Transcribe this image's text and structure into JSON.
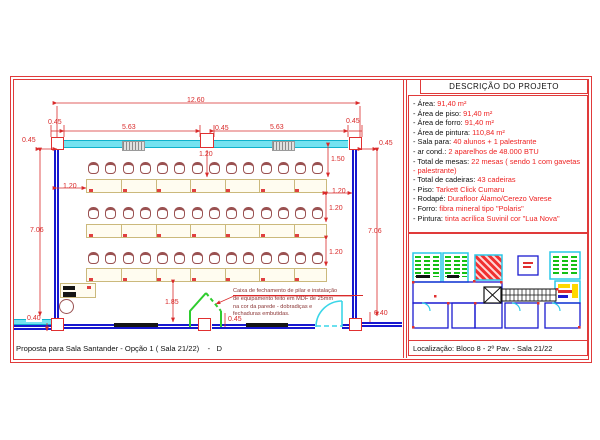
{
  "sheet": {
    "title_block": "Proposta para Sala Santander - Opção 1 ( Sala 21/22)    -   D"
  },
  "description_panel": {
    "header": "DESCRIÇÃO DO PROJETO",
    "items": [
      {
        "label": "- Área:",
        "value": "91,40 m²"
      },
      {
        "label": "- Área de piso:",
        "value": "91,40 m²"
      },
      {
        "label": "- Área de forro:",
        "value": "91,40 m²"
      },
      {
        "label": "- Área de pintura:",
        "value": "110,84 m²"
      },
      {
        "label": "- Sala para:",
        "value": "40 alunos + 1 palestrante"
      },
      {
        "label": "- ar cond.:",
        "value": "2 aparelhos de 48.000 BTU"
      },
      {
        "label": "- Total de mesas:",
        "value": "22 mesas ( sendo 1 com gavetas - palestrante)"
      },
      {
        "label": "- Total de cadeiras:",
        "value": "43 cadeiras"
      },
      {
        "label": "- Piso:",
        "value": "Tarkett Click Cumaru"
      },
      {
        "label": "- Rodapé:",
        "value": "Durafloor Álamo/Cerezo Varese"
      },
      {
        "label": "- Forro:",
        "value": "fibra mineral tipo \"Polaris\""
      },
      {
        "label": "- Pintura:",
        "value": "tinta acrílica Suvinil cor \"Lua Nova\""
      }
    ],
    "location_caption": "Localização: Bloco 8 - 2º Pav. - Sala 21/22"
  },
  "plan": {
    "note_lines": [
      "Caixa de fechamento de pilar e instalação",
      "de equipamento feito em MDF de 25mm",
      "na cor da parede - dobradiças e",
      "fechaduras embutidas."
    ],
    "dimensions": [
      {
        "id": "overall_width",
        "text": "12.60"
      },
      {
        "id": "col_tl",
        "text": "0.45"
      },
      {
        "id": "seg_left",
        "text": "5.63"
      },
      {
        "id": "col_mid",
        "text": "0.45"
      },
      {
        "id": "seg_right",
        "text": "5.63"
      },
      {
        "id": "col_tr",
        "text": "0.45"
      },
      {
        "id": "off_left",
        "text": "0.45"
      },
      {
        "id": "off_right",
        "text": "0.45"
      },
      {
        "id": "below_mid",
        "text": "1.20"
      },
      {
        "id": "first_row",
        "text": "1.50"
      },
      {
        "id": "gap_left",
        "text": "1.20"
      },
      {
        "id": "gap_right",
        "text": "1.20"
      },
      {
        "id": "row_gap1",
        "text": "1.20"
      },
      {
        "id": "row_gap2",
        "text": "1.20"
      },
      {
        "id": "height_left",
        "text": "7.06"
      },
      {
        "id": "height_right",
        "text": "7.06"
      },
      {
        "id": "front_gap",
        "text": "1.85"
      },
      {
        "id": "box_width",
        "text": "0.45"
      },
      {
        "id": "off_bottom_left",
        "text": "0.40"
      },
      {
        "id": "off_bottom_right",
        "text": "0.40"
      }
    ],
    "furniture": {
      "rows": 3,
      "tables_per_row": 7,
      "chairs_per_row": 14
    },
    "colors": {
      "frame_red": "#e03a3a",
      "dimension_red": "#d92b2b",
      "wall_blue": "#1717cf",
      "wall_cyan": "#74e2f0",
      "door_green": "#2ecc2e",
      "door_cyan": "#3ad6e8",
      "chair_brown": "#9a5151",
      "table_tan": "#cbb97c",
      "value_red": "#ee2222"
    }
  }
}
